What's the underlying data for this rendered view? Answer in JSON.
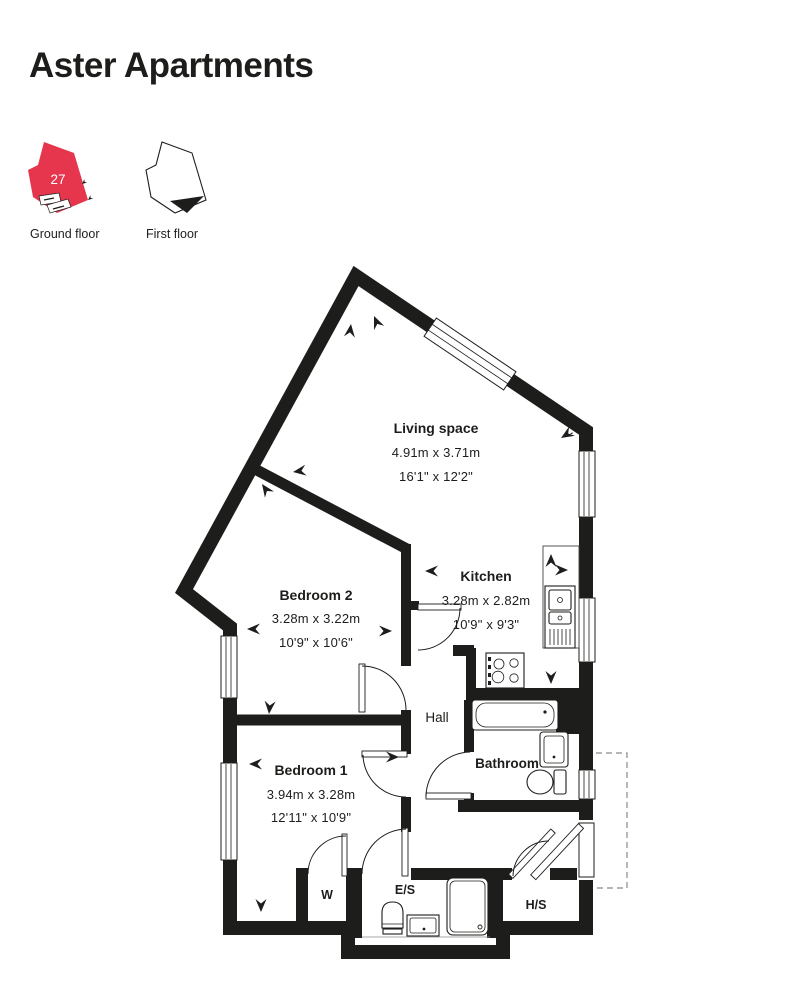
{
  "header": {
    "title": "Aster Apartments"
  },
  "colors": {
    "accent_red": "#e5364d",
    "wall": "#1d1d1b"
  },
  "floor_key": {
    "ground_floor": {
      "label": "Ground floor",
      "unit_number": "27"
    },
    "first_floor": {
      "label": "First floor"
    }
  },
  "rooms": {
    "living": {
      "name": "Living space",
      "metric": "4.91m x 3.71m",
      "imperial": "16'1\" x 12'2\""
    },
    "kitchen": {
      "name": "Kitchen",
      "metric": "3.28m x 2.82m",
      "imperial": "10'9\" x 9'3\""
    },
    "bedroom2": {
      "name": "Bedroom 2",
      "metric": "3.28m x 3.22m",
      "imperial": "10'9\" x 10'6\""
    },
    "bedroom1": {
      "name": "Bedroom 1",
      "metric": "3.94m x 3.28m",
      "imperial": "12'11\" x 10'9\""
    },
    "hall": {
      "name": "Hall"
    },
    "bathroom": {
      "name": "Bathroom"
    },
    "wardrobe": {
      "name": "W"
    },
    "ensuite": {
      "name": "E/S"
    },
    "storage": {
      "name": "H/S"
    }
  }
}
